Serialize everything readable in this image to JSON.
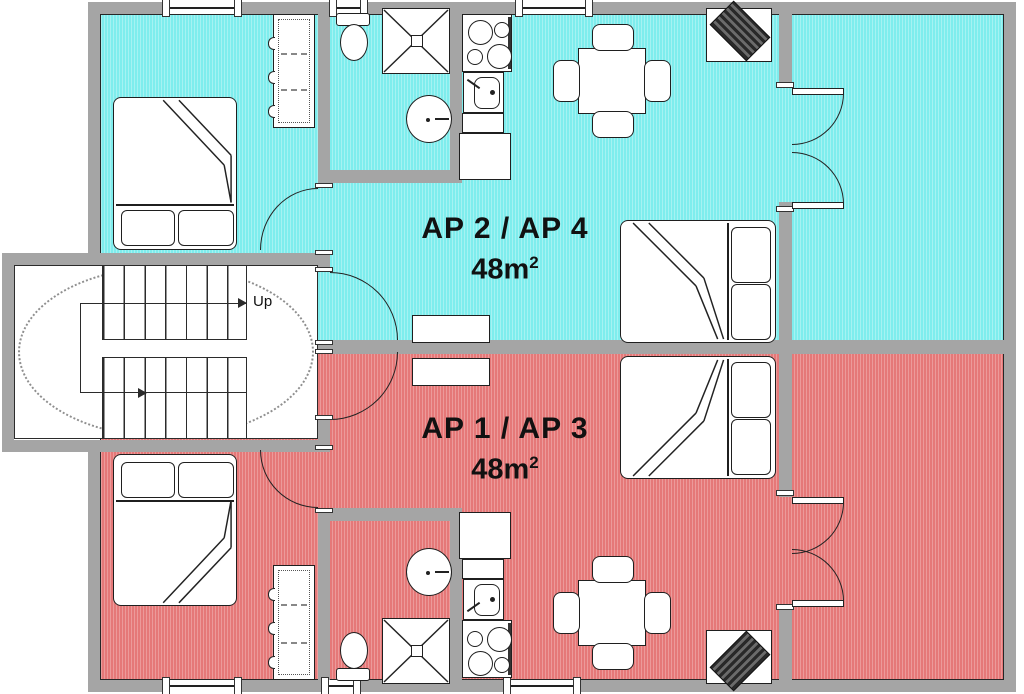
{
  "plan": {
    "apartments": [
      {
        "label": "AP 2 / AP 4",
        "area": "48m",
        "area_exp": "2",
        "color": "#7EEDED"
      },
      {
        "label": "AP 1 / AP 3",
        "area": "48m",
        "area_exp": "2",
        "color": "#E57878"
      }
    ],
    "stairs": {
      "up_label": "Up"
    },
    "colors": {
      "wall": "#A5A5A5",
      "outline": "#1F1F1F",
      "floor_cyan": "#7EEDED",
      "floor_red": "#E57878",
      "tv": "#4A4A4A"
    }
  }
}
